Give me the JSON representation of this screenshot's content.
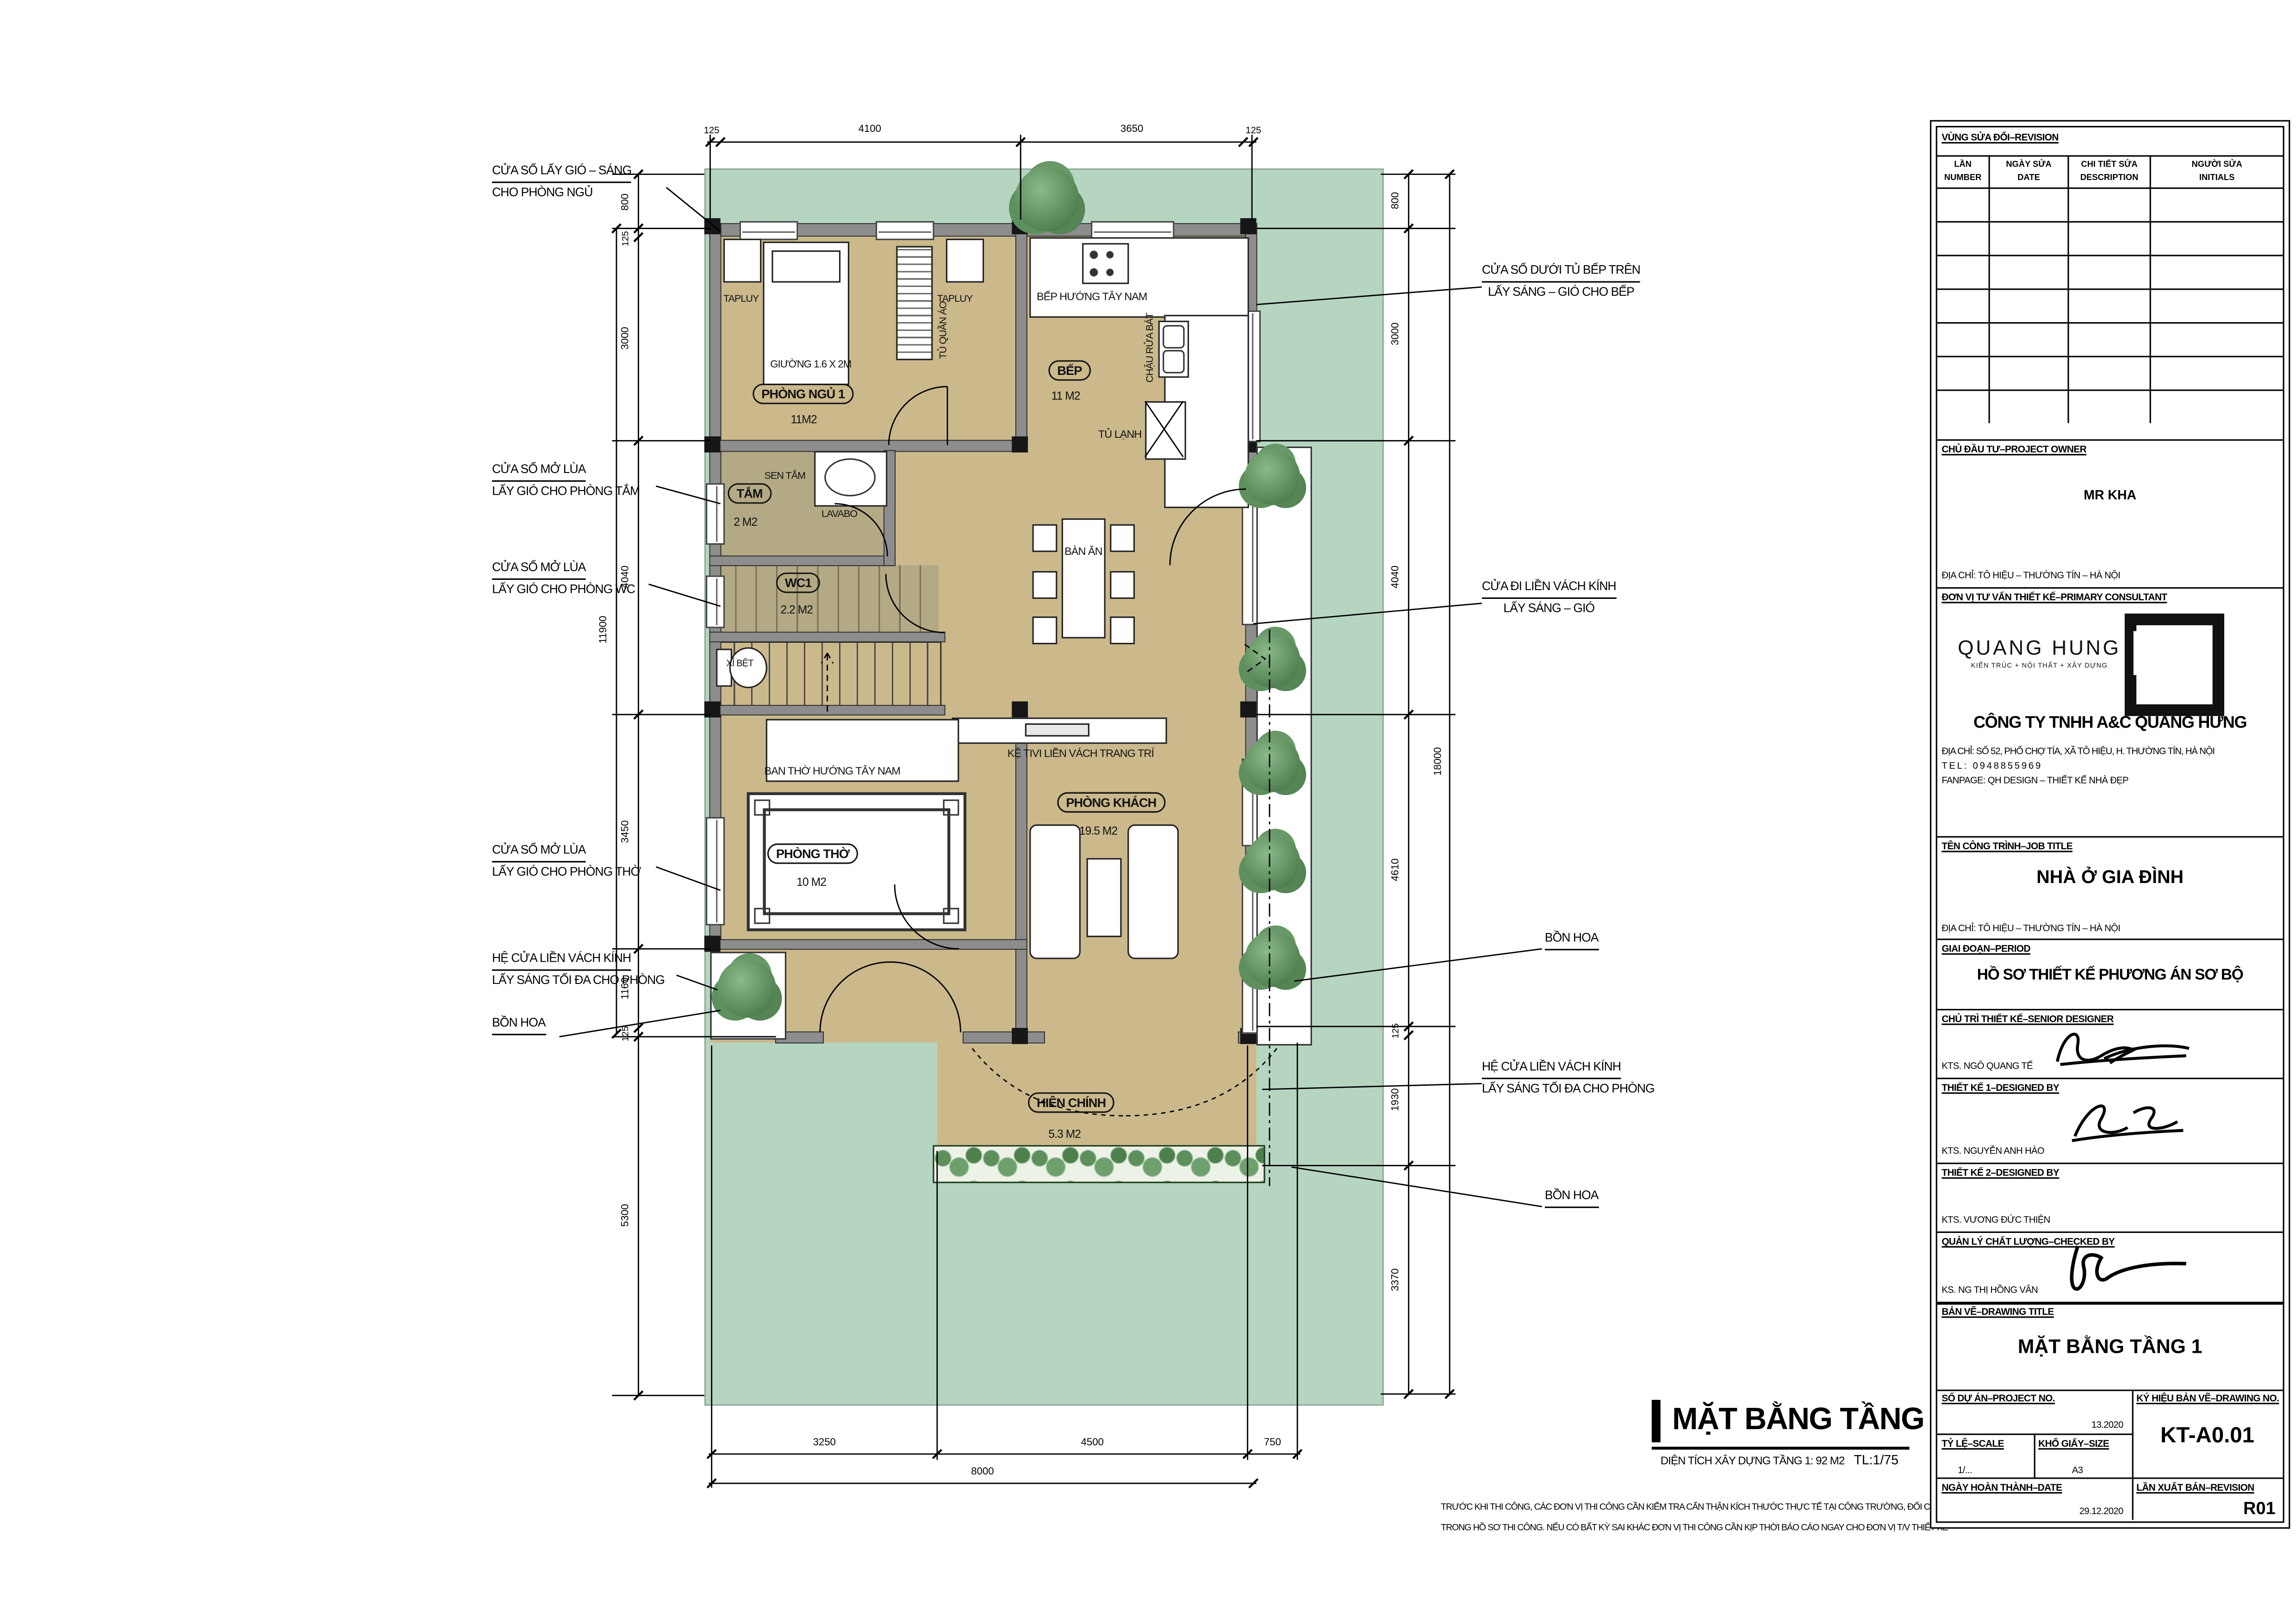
{
  "colors": {
    "site": "#b5d5c1",
    "floor": "#cbb98c",
    "wet_floor": "#b3aa85",
    "wall": "#8d8d8d",
    "hedge": "#5c8f5c"
  },
  "plan": {
    "rooms": {
      "bedroom": {
        "name": "PHÒNG NGỦ 1",
        "area": "11M2"
      },
      "kitchen": {
        "name": "BẾP",
        "area": "11 M2"
      },
      "bath": {
        "name": "TẮM",
        "area": "2 M2"
      },
      "wc": {
        "name": "WC1",
        "area": "2.2 M2"
      },
      "worship": {
        "name": "PHÒNG THỜ",
        "area": "10 M2"
      },
      "living": {
        "name": "PHÒNG KHÁCH",
        "area": "19.5 M2"
      },
      "porch": {
        "name": "HIÊN CHÍNH",
        "area": "5.3 M2"
      }
    },
    "furniture": {
      "tapluy_left": "TAPLUY",
      "tapluy_right": "TAPLUY",
      "bed": "GIƯỜNG 1.6 X 2M",
      "wardrobe": "TỦ QUẦN ÁO",
      "sen_tam": "SEN TẮM",
      "lavabo": "LAVABO",
      "xi_bet": "XÍ BỆT",
      "kitchen_dir": "BẾP HƯỚNG TÂY NAM",
      "sink": "CHẬU RỬA BÁT",
      "fridge": "TỦ LẠNH",
      "dining": "BÀN ĂN",
      "tv": "KỆ TIVI LIỀN VÁCH TRANG TRÍ",
      "altar": "BAN THỜ HƯỚNG TÂY NAM"
    }
  },
  "annotations": {
    "left": [
      {
        "line1": "CỬA SỔ LẤY GIÓ – SÁNG",
        "line2": "CHO PHÒNG NGỦ"
      },
      {
        "line1": "CỬA SỔ MỞ LÙA",
        "line2": "LẤY GIÓ CHO PHÒNG TẮM"
      },
      {
        "line1": "CỬA SỔ MỞ LÙA",
        "line2": "LẤY GIÓ CHO PHÒNG WC"
      },
      {
        "line1": "CỬA SỔ MỞ LÙA",
        "line2": "LẤY GIÓ CHO PHÒNG THỜ"
      },
      {
        "line1": "HỆ CỬA LIỀN VÁCH KÍNH",
        "line2": "LẤY SÁNG TỐI ĐA CHO PHÒNG"
      },
      {
        "line1": "BỒN HOA",
        "line2": ""
      }
    ],
    "right": [
      {
        "line1": "CỬA SỔ DƯỚI TỦ BẾP TRÊN",
        "line2": "LẤY SÁNG – GIÓ CHO BẾP"
      },
      {
        "line1": "CỬA ĐI LIỀN VÁCH KÍNH",
        "line2": "LẤY SÁNG – GIÓ"
      },
      {
        "line1": "BỒN HOA",
        "line2": ""
      },
      {
        "line1": "HỆ CỬA LIỀN VÁCH KÍNH",
        "line2": "LẤY SÁNG TỐI ĐA CHO PHÒNG"
      },
      {
        "line1": "BỒN HOA",
        "line2": ""
      }
    ]
  },
  "dims": {
    "top": [
      "125",
      "4100",
      "3650",
      "125"
    ],
    "bottom": [
      "3250",
      "4500",
      "750"
    ],
    "bottom_overall": "8000",
    "left": [
      "800",
      "125",
      "3000",
      "4040",
      "3450",
      "1160",
      "125",
      "5300"
    ],
    "left_overall": "11900",
    "right": [
      "800",
      "3000",
      "4040",
      "4610",
      "125",
      "1930",
      "3370"
    ],
    "right_overall": "18000"
  },
  "footer": {
    "title": "MẶT BẰNG TẦNG 1",
    "area": "DIỆN TÍCH XÂY DỰNG TẦNG 1: 92 M2",
    "scale": "TL:1/75",
    "note1": "TRƯỚC KHI THI CÔNG, CÁC ĐƠN VỊ THI CÔNG CẦN KIỂM TRA CẨN THẬN KÍCH THƯỚC THỰC TẾ TẠI CÔNG TRƯỜNG, ĐỐI CHIẾU CÁC BẢN VẼ",
    "note2": "TRONG HỒ SƠ THI CÔNG. NẾU CÓ BẤT KỲ SAI KHÁC ĐƠN VỊ THI CÔNG CẦN KỊP THỜI BÁO CÁO NGAY CHO ĐƠN VỊ T/V THIẾT KẾ"
  },
  "titleblock": {
    "revision": {
      "title": "VÙNG SỬA ĐỔI–REVISION",
      "col1a": "LẦN",
      "col1b": "NUMBER",
      "col2a": "NGÀY SỬA",
      "col2b": "DATE",
      "col3a": "CHI TIẾT SỬA",
      "col3b": "DESCRIPTION",
      "col4a": "NGƯỜI SỬA",
      "col4b": "INITIALS",
      "empty_rows": 7
    },
    "owner": {
      "label": "CHỦ ĐẦU TƯ–PROJECT OWNER",
      "name": "MR KHA",
      "address": "ĐỊA CHỈ: TÔ HIỆU – THƯỜNG TÍN – HÀ NỘI"
    },
    "consultant": {
      "label": "ĐƠN VỊ TƯ VẤN THIẾT KẾ–PRIMARY CONSULTANT",
      "logo_name": "QUANG HUNG",
      "logo_tagline": "KIẾN TRÚC + NỘI THẤT + XÂY DỰNG",
      "company": "CÔNG TY TNHH A&C QUANG HƯNG",
      "address": "ĐỊA CHỈ: SỐ 52, PHỐ CHỢ TÍA, XÃ TÔ HIỆU, H. THƯỜNG TÍN, HÀ NỘI",
      "tel": "TEL: 0948855969",
      "fanpage": "FANPAGE: QH DESIGN – THIẾT KẾ NHÀ ĐẸP"
    },
    "job": {
      "label": "TÊN CÔNG TRÌNH–JOB TITLE",
      "title": "NHÀ Ở GIA ĐÌNH",
      "address": "ĐỊA CHỈ: TÔ HIỆU – THƯỜNG TÍN – HÀ NỘI"
    },
    "period": {
      "label": "GIAI ĐOẠN–PERIOD",
      "value": "HỒ SƠ THIẾT KẾ PHƯƠNG ÁN SƠ BỘ"
    },
    "senior": {
      "label": "CHỦ TRÌ THIẾT KẾ–SENIOR DESIGNER",
      "name": "KTS. NGÔ QUANG TẾ"
    },
    "design1": {
      "label": "THIẾT KẾ 1–DESIGNED BY",
      "name": "KTS. NGUYỄN ANH HÀO"
    },
    "design2": {
      "label": "THIẾT KẾ 2–DESIGNED BY",
      "name": "KTS. VƯƠNG ĐỨC THIỆN"
    },
    "checked": {
      "label": "QUẢN LÝ CHẤT LƯỢNG–CHECKED BY",
      "name": "KS. NG THỊ HỒNG VÂN"
    },
    "drawing": {
      "label": "BẢN VẼ–DRAWING TITLE",
      "title": "MẶT BẰNG TẦNG 1"
    },
    "meta": {
      "project_label": "SỐ DỰ ÁN–PROJECT NO.",
      "project_no": "13.2020",
      "drawingno_label": "KÝ HIỆU BẢN VẼ–DRAWING NO.",
      "drawing_no": "KT-A0.01",
      "scale_label": "TỶ LỆ–SCALE",
      "scale": "1/...",
      "size_label": "KHỔ GIẤY–SIZE",
      "size": "A3",
      "date_label": "NGÀY HOÀN THÀNH–DATE",
      "date": "29.12.2020",
      "rev_label": "LẦN XUẤT BẢN–REVISION",
      "rev": "R01"
    }
  }
}
